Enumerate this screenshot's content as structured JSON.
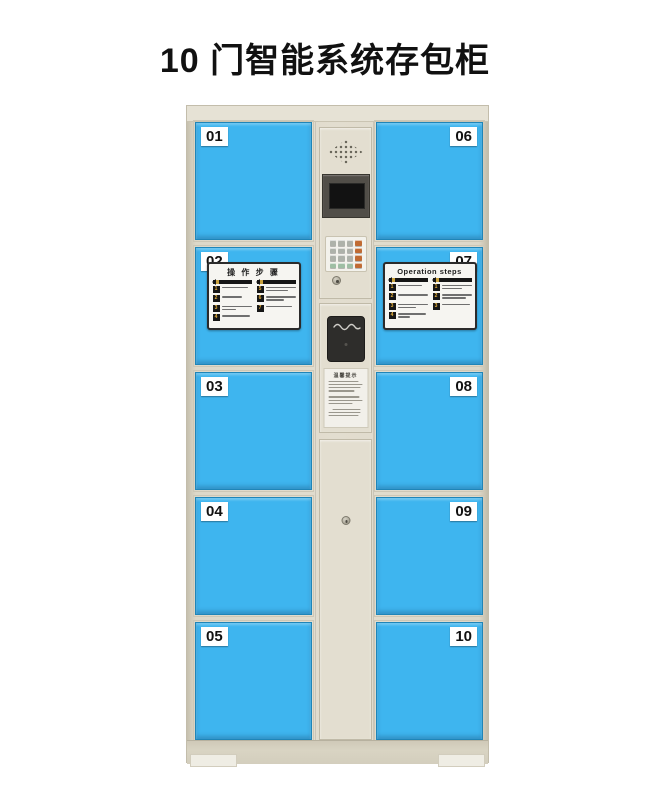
{
  "page": {
    "title": "10 门智能系统存包柜"
  },
  "doors": {
    "left": [
      "01",
      "02",
      "03",
      "04",
      "05"
    ],
    "right": [
      "06",
      "07",
      "08",
      "09",
      "10"
    ]
  },
  "sticker_cn": {
    "title": "操 作 步 骤",
    "left_steps": [
      "1",
      "2",
      "3",
      "4"
    ],
    "right_steps": [
      "5",
      "6",
      "7",
      "8"
    ]
  },
  "sticker_en": {
    "title": "Operation steps",
    "left_steps": [
      "1",
      "2",
      "3",
      "4"
    ],
    "right_steps": [
      "1",
      "2",
      "3"
    ]
  },
  "control_panel": {
    "notice_title": "温馨提示"
  },
  "icons": {
    "speaker": "dot-grid-speaker",
    "screen": "lcd-display",
    "keypad": "4x4-keypad",
    "lock": "round-cam-lock",
    "scanner": "barcode-scanner-window"
  },
  "colors": {
    "door_blue": "#3EB5EF",
    "body_beige": "#E0DBCC",
    "edge_shade": "#C7C1AF",
    "base": "#D7D2C1",
    "screen_black": "#121212",
    "key_gray": "#AEB2AA",
    "key_green": "#9FBFA4",
    "key_orange": "#C06B33",
    "label_bg": "#FFFFFF",
    "title_text": "#111111"
  }
}
